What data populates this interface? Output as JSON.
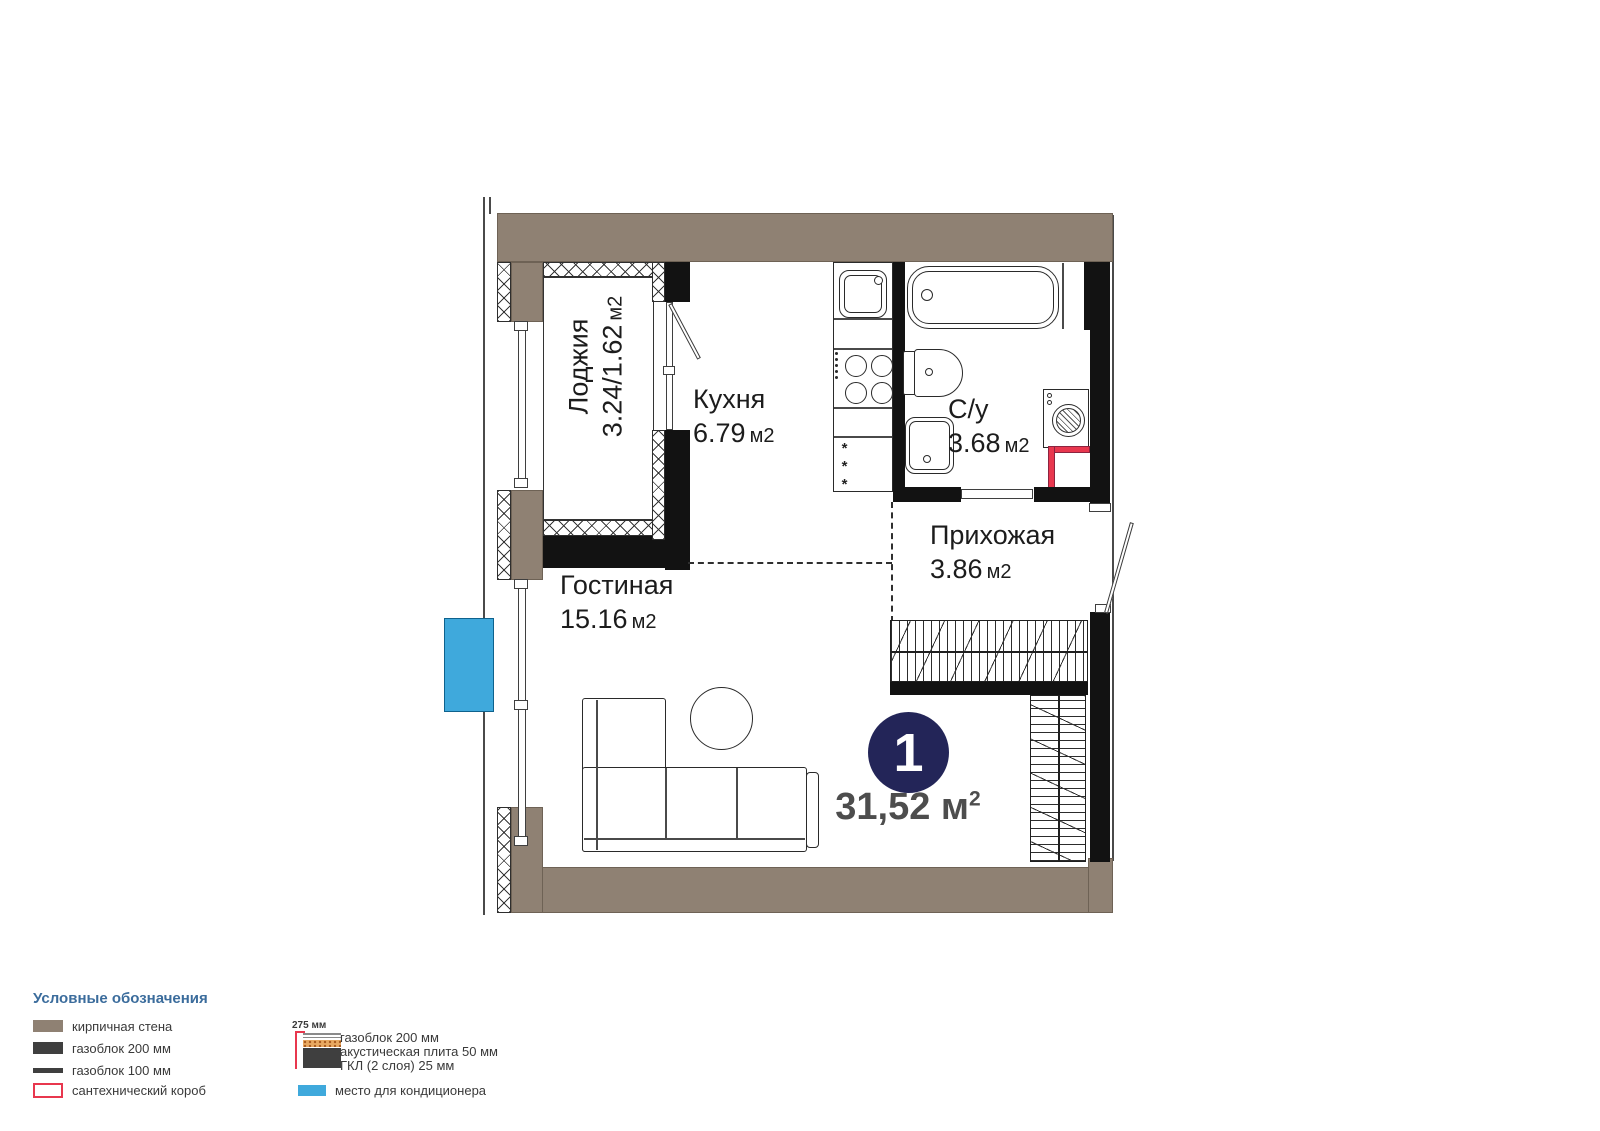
{
  "plan": {
    "rooms": {
      "loggia": {
        "name": "Лоджия",
        "value": "3.24/1.62",
        "unit": "м2"
      },
      "kitchen": {
        "name": "Кухня",
        "value": "6.79",
        "unit": "м2"
      },
      "bathroom": {
        "name": "С/у",
        "value": "3.68",
        "unit": "м2"
      },
      "hallway": {
        "name": "Прихожая",
        "value": "3.86",
        "unit": "м2"
      },
      "living": {
        "name": "Гостиная",
        "value": "15.16",
        "unit": "м2"
      }
    },
    "badge": {
      "room_count": "1",
      "area_value": "31,52",
      "area_unit": "м",
      "area_sup": "2"
    },
    "fridge_marks": "***"
  },
  "legend": {
    "title": "Условные обозначения",
    "items": {
      "brick": "кирпичная стена",
      "gasblock200": "газоблок 200 мм",
      "gasblock100": "газоблок 100 мм",
      "plumbing_box": "сантехнический короб",
      "ac_place": "место для кондиционера"
    },
    "layered": {
      "dimension": "275 мм",
      "line1": "газоблок 200 мм",
      "line2": "акустическая плита 50 мм",
      "line3": "ГКЛ (2 слоя) 25 мм"
    }
  },
  "colors": {
    "brick": "#8F8173",
    "wall_black": "#121212",
    "badge_navy": "#232558",
    "ac_blue": "#3FA9DC",
    "plumbing_red": "#E8374E",
    "legend_title_blue": "#3B6C9C"
  }
}
